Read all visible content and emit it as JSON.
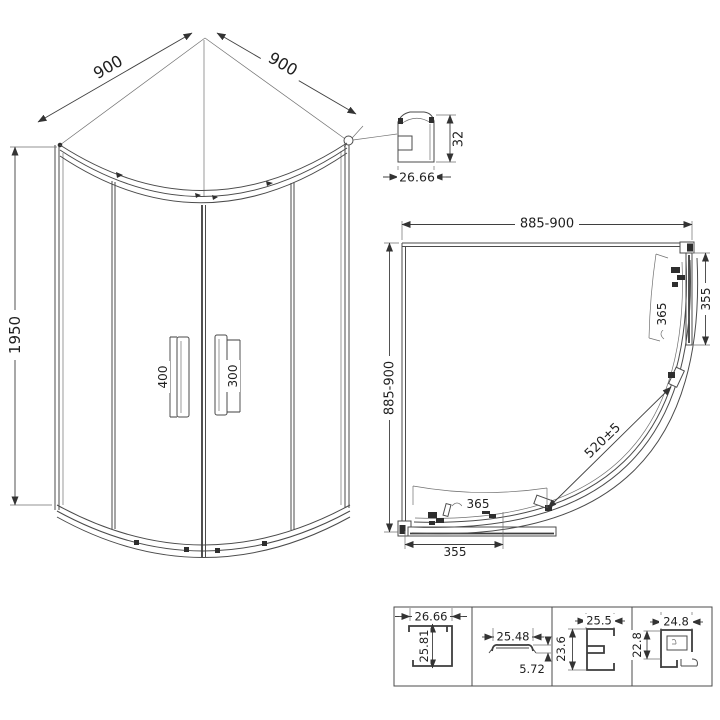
{
  "front_elevation": {
    "width_left": "900",
    "width_right": "900",
    "height": "1950",
    "handle_left": "400",
    "handle_right": "300"
  },
  "top_rail_profile": {
    "width": "26.66",
    "height": "32"
  },
  "plan_view": {
    "width_top": "885-900",
    "depth_left": "885-900",
    "side_panel_width": "355",
    "bottom_panel_width": "355",
    "door_arc_right": "365",
    "door_arc_bottom": "365",
    "diagonal_opening": "520±5"
  },
  "profile_details": [
    {
      "width": "26.66",
      "height": "25.81"
    },
    {
      "width": "25.48",
      "height": "5.72"
    },
    {
      "width": "25.5",
      "height": "23.6"
    },
    {
      "width": "24.8",
      "height": "22.8"
    }
  ]
}
